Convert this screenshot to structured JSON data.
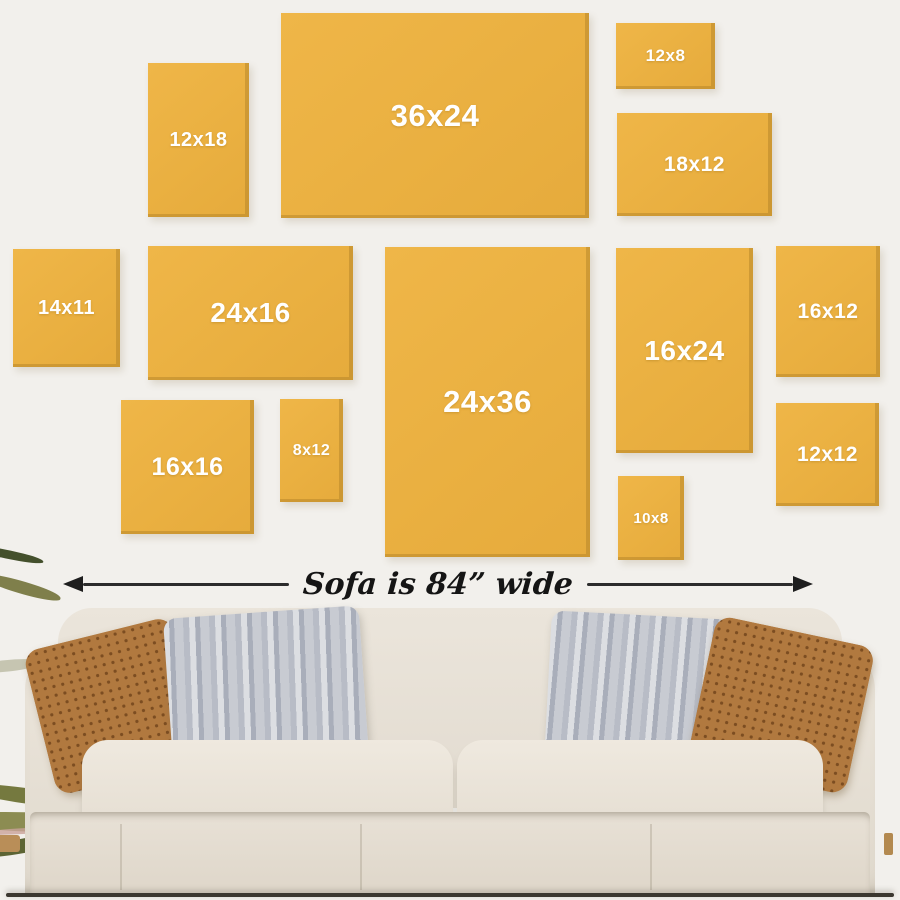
{
  "title": "Wall art size guide above a sofa",
  "colors": {
    "wall": "#f2f0ec",
    "frame_yellow": "#eab041",
    "frame_edge_shadow": "#ac7e26",
    "frame_label_text": "#ffffff",
    "arrow_black": "#1e1e1e",
    "sofa_beige": "#e8e2d8",
    "pillow_rust": "#b1793f",
    "pillow_gray": "#c4c7ce",
    "plant_olive": "#7f7f4b"
  },
  "frames": [
    {
      "label": "12x18",
      "x": 148,
      "y": 63,
      "w": 101,
      "h": 154,
      "fs": 20
    },
    {
      "label": "36x24",
      "x": 281,
      "y": 13,
      "w": 308,
      "h": 205,
      "fs": 31
    },
    {
      "label": "12x8",
      "x": 616,
      "y": 23,
      "w": 99,
      "h": 66,
      "fs": 17
    },
    {
      "label": "18x12",
      "x": 617,
      "y": 113,
      "w": 155,
      "h": 103,
      "fs": 21
    },
    {
      "label": "14x11",
      "x": 13,
      "y": 249,
      "w": 107,
      "h": 118,
      "fs": 20
    },
    {
      "label": "24x16",
      "x": 148,
      "y": 246,
      "w": 205,
      "h": 134,
      "fs": 28
    },
    {
      "label": "24x36",
      "x": 385,
      "y": 247,
      "w": 205,
      "h": 310,
      "fs": 31
    },
    {
      "label": "16x24",
      "x": 616,
      "y": 248,
      "w": 137,
      "h": 205,
      "fs": 28
    },
    {
      "label": "16x12",
      "x": 776,
      "y": 246,
      "w": 104,
      "h": 131,
      "fs": 21
    },
    {
      "label": "16x16",
      "x": 121,
      "y": 400,
      "w": 133,
      "h": 134,
      "fs": 25
    },
    {
      "label": "8x12",
      "x": 280,
      "y": 399,
      "w": 63,
      "h": 103,
      "fs": 16
    },
    {
      "label": "12x12",
      "x": 776,
      "y": 403,
      "w": 103,
      "h": 103,
      "fs": 21
    },
    {
      "label": "10x8",
      "x": 618,
      "y": 476,
      "w": 66,
      "h": 84,
      "fs": 15
    }
  ],
  "arrow": {
    "label": "Sofa is 84” wide"
  }
}
